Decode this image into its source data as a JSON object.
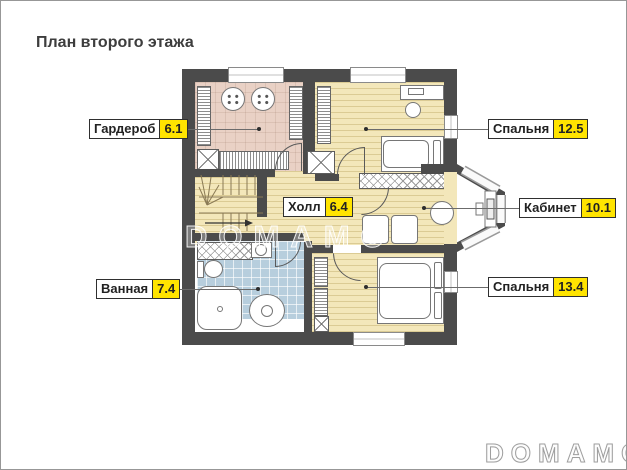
{
  "page": {
    "title": "План второго этажа",
    "watermark_center": "DOMAMO",
    "watermark_footer": "DOMAMO"
  },
  "rooms": [
    {
      "name": "Гардероб",
      "area": "6.1"
    },
    {
      "name": "Спальня",
      "area": "12.5"
    },
    {
      "name": "Холл",
      "area": "6.4"
    },
    {
      "name": "Кабинет",
      "area": "10.1"
    },
    {
      "name": "Ванная",
      "area": "7.4"
    },
    {
      "name": "Спальня",
      "area": "13.4"
    }
  ],
  "colors": {
    "accent_yellow": "#ffe400",
    "wall_dark": "#4b4b4b",
    "floor_wood": "#f3e7ba",
    "floor_pink": "#e9d1c5",
    "floor_tile": "#b7cedd"
  }
}
